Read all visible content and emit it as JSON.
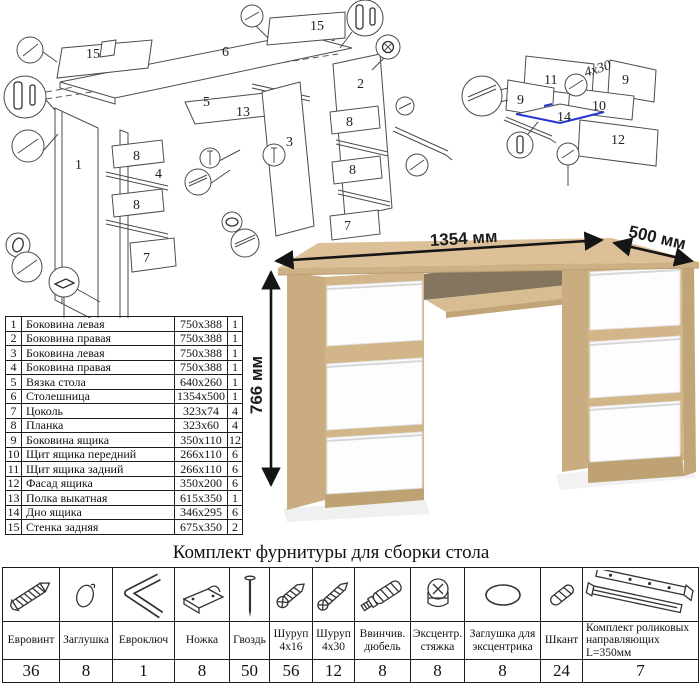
{
  "parts_table": {
    "rows": [
      {
        "n": "1",
        "name": "Боковина левая",
        "size": "750x388",
        "qty": "1"
      },
      {
        "n": "2",
        "name": "Боковина правая",
        "size": "750x388",
        "qty": "1"
      },
      {
        "n": "3",
        "name": "Боковина левая",
        "size": "750x388",
        "qty": "1"
      },
      {
        "n": "4",
        "name": "Боковина правая",
        "size": "750x388",
        "qty": "1"
      },
      {
        "n": "5",
        "name": "Вязка стола",
        "size": "640x260",
        "qty": "1"
      },
      {
        "n": "6",
        "name": "Столешница",
        "size": "1354x500",
        "qty": "1"
      },
      {
        "n": "7",
        "name": "Цоколь",
        "size": "323x74",
        "qty": "4"
      },
      {
        "n": "8",
        "name": "Планка",
        "size": "323x60",
        "qty": "4"
      },
      {
        "n": "9",
        "name": "Боковина ящика",
        "size": "350x110",
        "qty": "12"
      },
      {
        "n": "10",
        "name": "Щит ящика передний",
        "size": "266x110",
        "qty": "6"
      },
      {
        "n": "11",
        "name": "Щит ящика задний",
        "size": "266x110",
        "qty": "6"
      },
      {
        "n": "12",
        "name": "Фасад ящика",
        "size": "350x200",
        "qty": "6"
      },
      {
        "n": "13",
        "name": "Полка выкатная",
        "size": "615x350",
        "qty": "1"
      },
      {
        "n": "14",
        "name": "Дно ящика",
        "size": "346x295",
        "qty": "6"
      },
      {
        "n": "15",
        "name": "Стенка задняя",
        "size": "675x350",
        "qty": "2"
      }
    ]
  },
  "dimensions": {
    "width": "1354 мм",
    "depth": "500 мм",
    "height": "766 мм"
  },
  "hardware_kit": {
    "title": "Комплект фурнитуры для сборки стола",
    "items": [
      {
        "name": "Евровинт",
        "qty": "36",
        "icon": "euro-screw-icon"
      },
      {
        "name": "Заглушка",
        "qty": "8",
        "icon": "cap-icon"
      },
      {
        "name": "Евроключ",
        "qty": "1",
        "icon": "hex-key-icon"
      },
      {
        "name": "Ножка",
        "qty": "8",
        "icon": "foot-icon"
      },
      {
        "name": "Гвоздь",
        "qty": "50",
        "icon": "nail-icon"
      },
      {
        "name": "Шуруп 4x16",
        "qty": "56",
        "icon": "screw-short-icon"
      },
      {
        "name": "Шуруп 4x30",
        "qty": "12",
        "icon": "screw-long-icon"
      },
      {
        "name": "Ввинчив. дюбель",
        "qty": "8",
        "icon": "screw-in-dowel-icon"
      },
      {
        "name": "Эксцентр. стяжка",
        "qty": "8",
        "icon": "cam-lock-icon"
      },
      {
        "name": "Заглушка для эксцентрика",
        "qty": "8",
        "icon": "cam-cap-icon"
      },
      {
        "name": "Шкант",
        "qty": "24",
        "icon": "wood-dowel-icon"
      },
      {
        "name": "Комплект роликовых направляющих L=350мм",
        "qty": "7",
        "icon": "drawer-slides-icon"
      }
    ]
  },
  "exploded_view": {
    "labels": [
      "15",
      "6",
      "15",
      "5",
      "13",
      "3",
      "2",
      "1",
      "8",
      "4",
      "8",
      "7",
      "8",
      "8",
      "7"
    ]
  },
  "drawer_view": {
    "labels": [
      "11",
      "9",
      "9",
      "10",
      "14",
      "12"
    ],
    "annotation": "4x30"
  },
  "colors": {
    "wood": "#dcc198",
    "wood_mid": "#d2b689",
    "wood_dark": "#c2a577",
    "accent_blue": "#2635cf"
  }
}
